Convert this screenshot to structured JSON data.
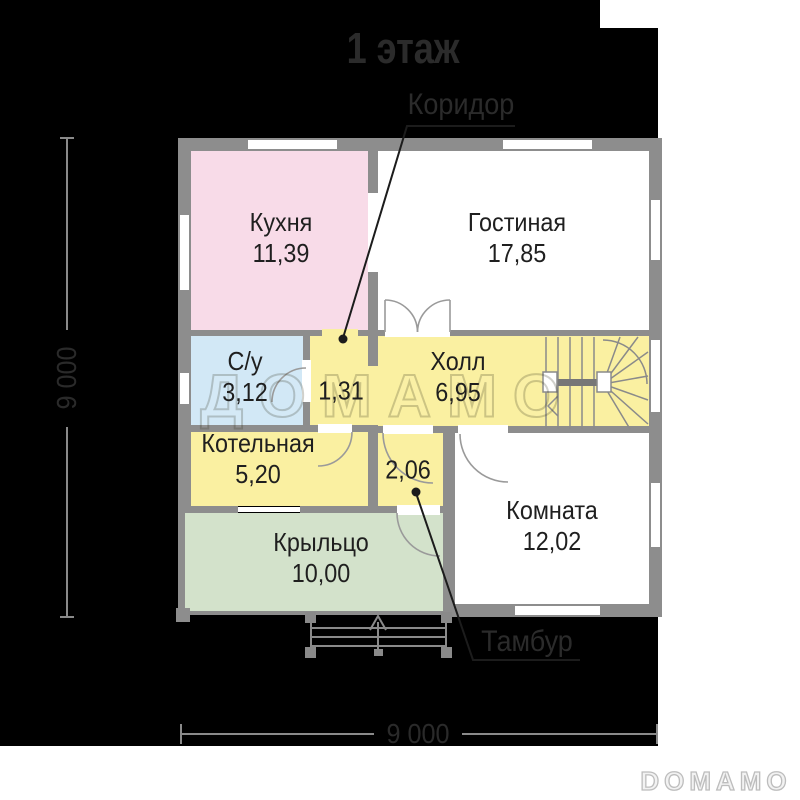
{
  "title": "1 этаж",
  "watermark": "ДОМАМО",
  "logo": "DOMAMO",
  "callouts": {
    "corridor_label": "Коридор",
    "tambour_label": "Тамбур"
  },
  "rooms": {
    "kitchen": {
      "name": "Кухня",
      "area": "11,39",
      "color": "#f8dbe8"
    },
    "living": {
      "name": "Гостиная",
      "area": "17,85",
      "color": "#ffffff"
    },
    "bathroom": {
      "name": "С/у",
      "area": "3,12",
      "color": "#d2e8f6"
    },
    "corridor": {
      "area": "1,31",
      "color": "#faf0a1"
    },
    "hall": {
      "name": "Холл",
      "area": "6,95",
      "color": "#faf0a1"
    },
    "boiler": {
      "name": "Котельная",
      "area": "5,20",
      "color": "#faf0a1"
    },
    "tambour": {
      "area": "2,06",
      "color": "#faf0a1"
    },
    "room": {
      "name": "Комната",
      "area": "12,02",
      "color": "#ffffff"
    },
    "porch": {
      "name": "Крыльцо",
      "area": "10,00",
      "color": "#d3e2cb"
    }
  },
  "dimensions": {
    "width": "9 000",
    "height": "9 000"
  },
  "colors": {
    "background": "#000000",
    "wall": "#8d8d8d",
    "label_text": "#1f1f1f",
    "annotation_text": "#2b2b2b",
    "dimension_line": "#8a8a8a",
    "logo_outline": "#bdbdbd"
  }
}
